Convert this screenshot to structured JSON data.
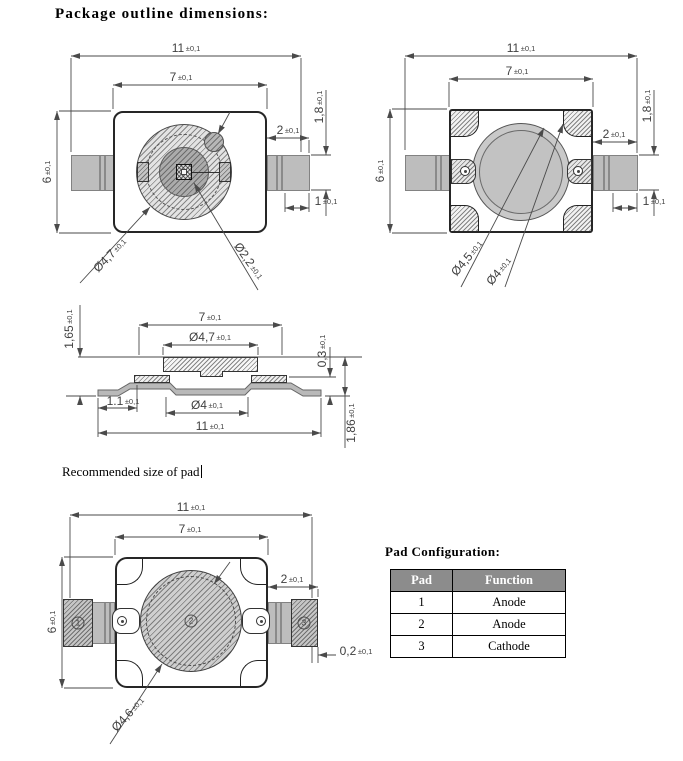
{
  "page": {
    "title": "Package outline dimensions:",
    "note": "Recommended size of pad"
  },
  "colors": {
    "lead_gray": "#bdbdbd",
    "circle_fill": "#c9c9c9",
    "table_header_bg": "#8c8c8c",
    "line_color": "#4a4a4a"
  },
  "pads": {
    "p1": "1",
    "p2": "2",
    "p3": "3"
  },
  "dims": {
    "front": {
      "outer_width": {
        "v": "11",
        "t": "±0,1"
      },
      "body_width": {
        "v": "7",
        "t": "±0,1"
      },
      "body_height": {
        "v": "6",
        "t": "±0,1"
      },
      "lead_width": {
        "v": "2",
        "t": "±0,1"
      },
      "lead_height": {
        "v": "1,8",
        "t": "±0,1"
      },
      "foot_length": {
        "v": "1",
        "t": "±0,1"
      },
      "lens_dia": {
        "v": "Ø4,7",
        "t": "±0,1"
      },
      "cup_dia": {
        "v": "Ø2,2",
        "t": "±0,1"
      }
    },
    "back": {
      "outer_width": {
        "v": "11",
        "t": "±0,1"
      },
      "body_width": {
        "v": "7",
        "t": "±0,1"
      },
      "body_height": {
        "v": "6",
        "t": "±0,1"
      },
      "lead_width": {
        "v": "2",
        "t": "±0,1"
      },
      "lead_height": {
        "v": "1,8",
        "t": "±0,1"
      },
      "foot_length": {
        "v": "1",
        "t": "±0,1"
      },
      "ring_dia": {
        "v": "Ø4,5",
        "t": "±0,1"
      },
      "window_dia": {
        "v": "Ø4",
        "t": "±0,1"
      }
    },
    "side": {
      "stand_height": {
        "v": "1,65",
        "t": "±0,1"
      },
      "body_width": {
        "v": "7",
        "t": "±0,1"
      },
      "lens_dia": {
        "v": "Ø4,7",
        "t": "±0,1"
      },
      "step_height": {
        "v": "0,3",
        "t": "±0,1"
      },
      "foot_length": {
        "v": "1.1",
        "t": "±0,1"
      },
      "base_dia": {
        "v": "Ø4",
        "t": "±0,1"
      },
      "outer_width": {
        "v": "11",
        "t": "±0,1"
      },
      "total_height": {
        "v": "1,86",
        "t": "±0,1"
      }
    },
    "pad": {
      "outer_width": {
        "v": "11",
        "t": "±0,1"
      },
      "body_width": {
        "v": "7",
        "t": "±0,1"
      },
      "body_height": {
        "v": "6",
        "t": "±0,1"
      },
      "pad_width": {
        "v": "2",
        "t": "±0,1"
      },
      "gap": {
        "v": "0,2",
        "t": "±0,1"
      },
      "circle_dia": {
        "v": "Ø4,6",
        "t": "±0,1"
      }
    }
  },
  "table": {
    "title": "Pad Configuration:",
    "headers": [
      "Pad",
      "Function"
    ],
    "rows": [
      [
        "1",
        "Anode"
      ],
      [
        "2",
        "Anode"
      ],
      [
        "3",
        "Cathode"
      ]
    ]
  }
}
